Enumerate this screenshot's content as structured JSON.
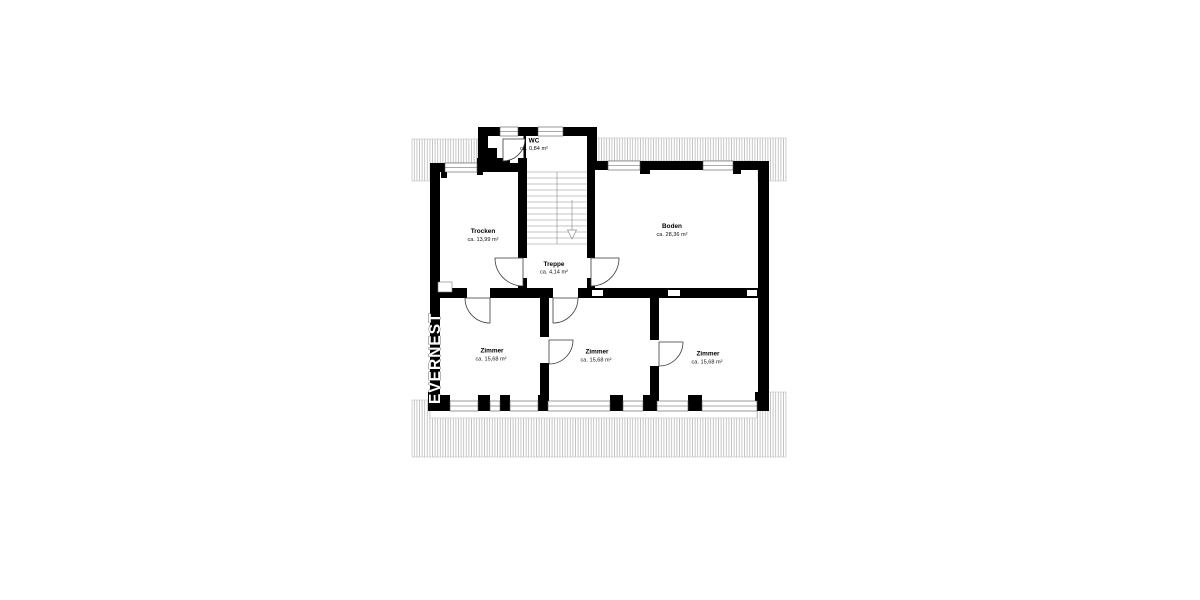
{
  "watermark": {
    "text": "EVERNEST",
    "mark": "™"
  },
  "plan": {
    "rooms": [
      {
        "id": "wc",
        "name": "WC",
        "area": "ca. 0,84 m²"
      },
      {
        "id": "trocken",
        "name": "Trocken",
        "area": "ca. 13,99 m²"
      },
      {
        "id": "boden",
        "name": "Boden",
        "area": "ca. 28,36 m²"
      },
      {
        "id": "treppe",
        "name": "Treppe",
        "area": "ca. 4,14 m²"
      },
      {
        "id": "zimmer-left",
        "name": "Zimmer",
        "area": "ca. 15,68 m²"
      },
      {
        "id": "zimmer-middle",
        "name": "Zimmer",
        "area": "ca. 15,68 m²"
      },
      {
        "id": "zimmer-right",
        "name": "Zimmer",
        "area": "ca. 15,68 m²"
      }
    ],
    "colors": {
      "wall": "#000000",
      "background": "#ffffff",
      "hatch_line": "#9a9a9a",
      "door_line": "#3a3a3a"
    }
  }
}
